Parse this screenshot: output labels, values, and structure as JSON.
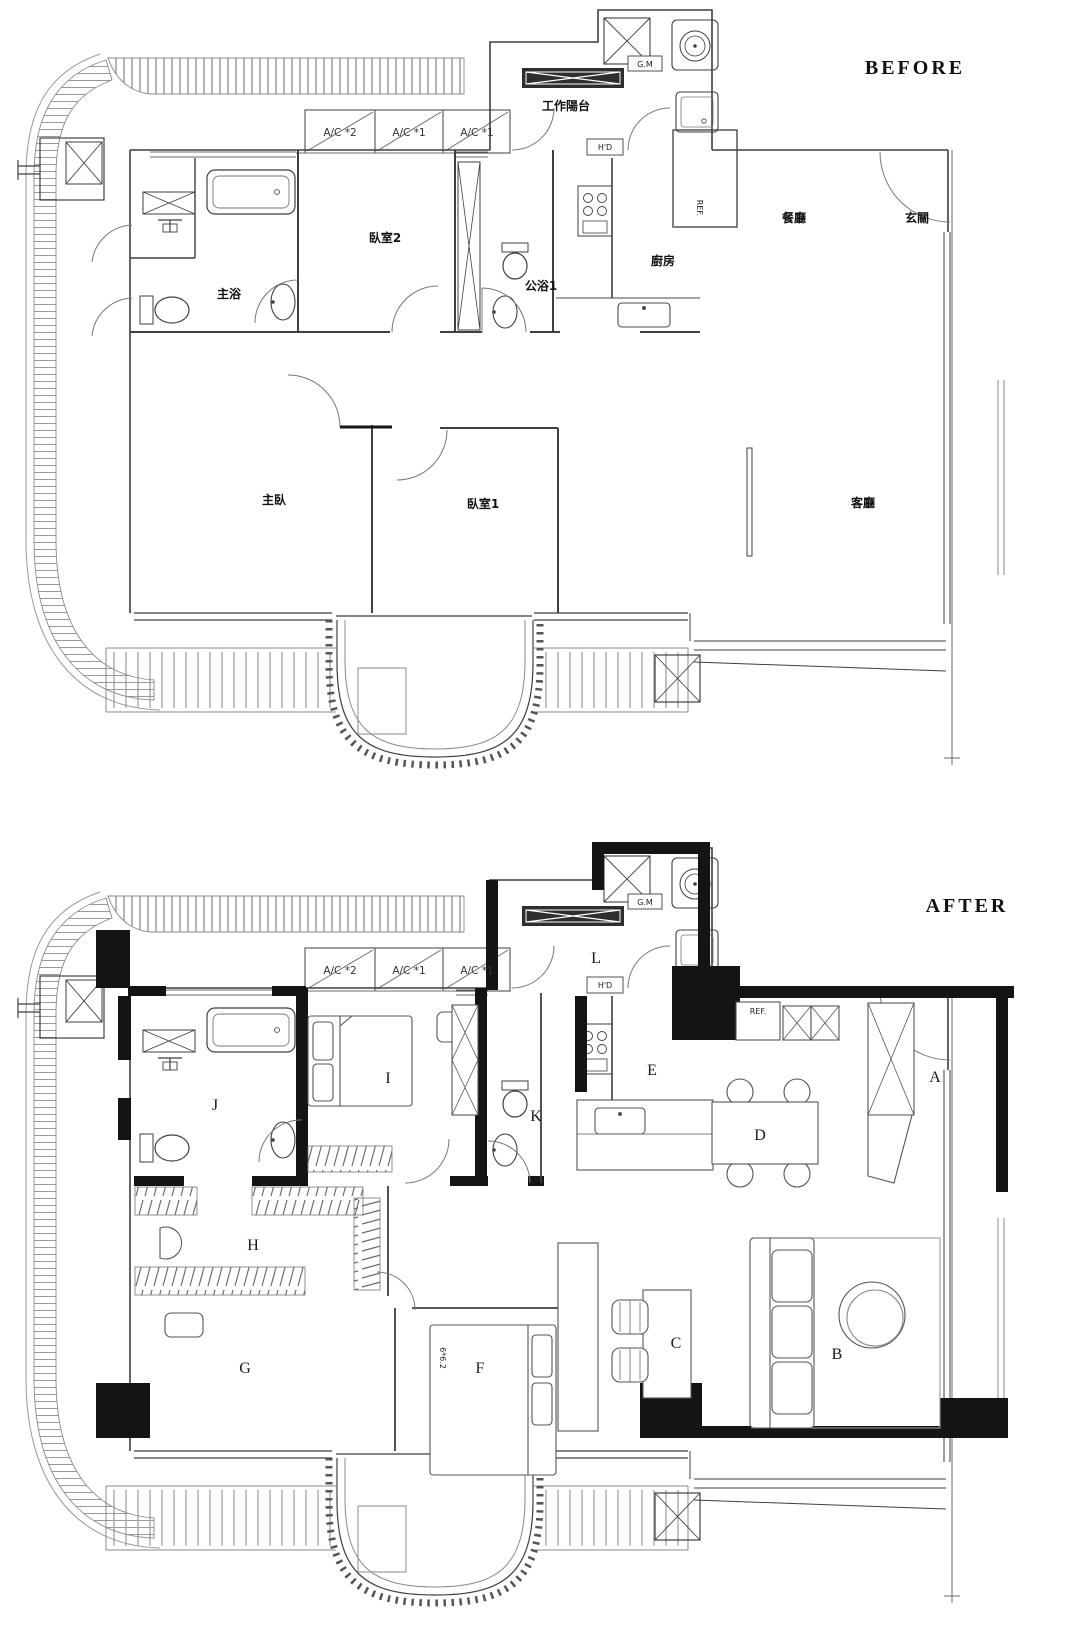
{
  "page": {
    "background": "#ffffff",
    "line_color": "#3f3f3f",
    "wall_black": "#141414"
  },
  "before": {
    "title": "BEFORE",
    "labels": {
      "work_balcony": "工作陽台",
      "ac2": "A/C *2",
      "ac1a": "A/C *1",
      "ac1b": "A/C *1",
      "gm": "G.M",
      "hd": "H'D",
      "ref": "REF.",
      "bedroom2": "臥室2",
      "master_bath": "主浴",
      "public_bath1": "公浴1",
      "kitchen": "廚房",
      "dining": "餐廳",
      "foyer": "玄關",
      "master_bedroom": "主臥",
      "bedroom1": "臥室1",
      "living_room": "客廳"
    }
  },
  "after": {
    "title": "AFTER",
    "labels": {
      "ac2": "A/C *2",
      "ac1a": "A/C *1",
      "ac1b": "A/C *1",
      "gm": "G.M",
      "hd": "H'D",
      "ref": "REF.",
      "bed_size": "6*6.2",
      "a": "A",
      "b": "B",
      "c": "C",
      "d": "D",
      "e": "E",
      "f": "F",
      "g": "G",
      "h": "H",
      "i": "I",
      "j": "J",
      "k": "K",
      "l": "L"
    }
  }
}
